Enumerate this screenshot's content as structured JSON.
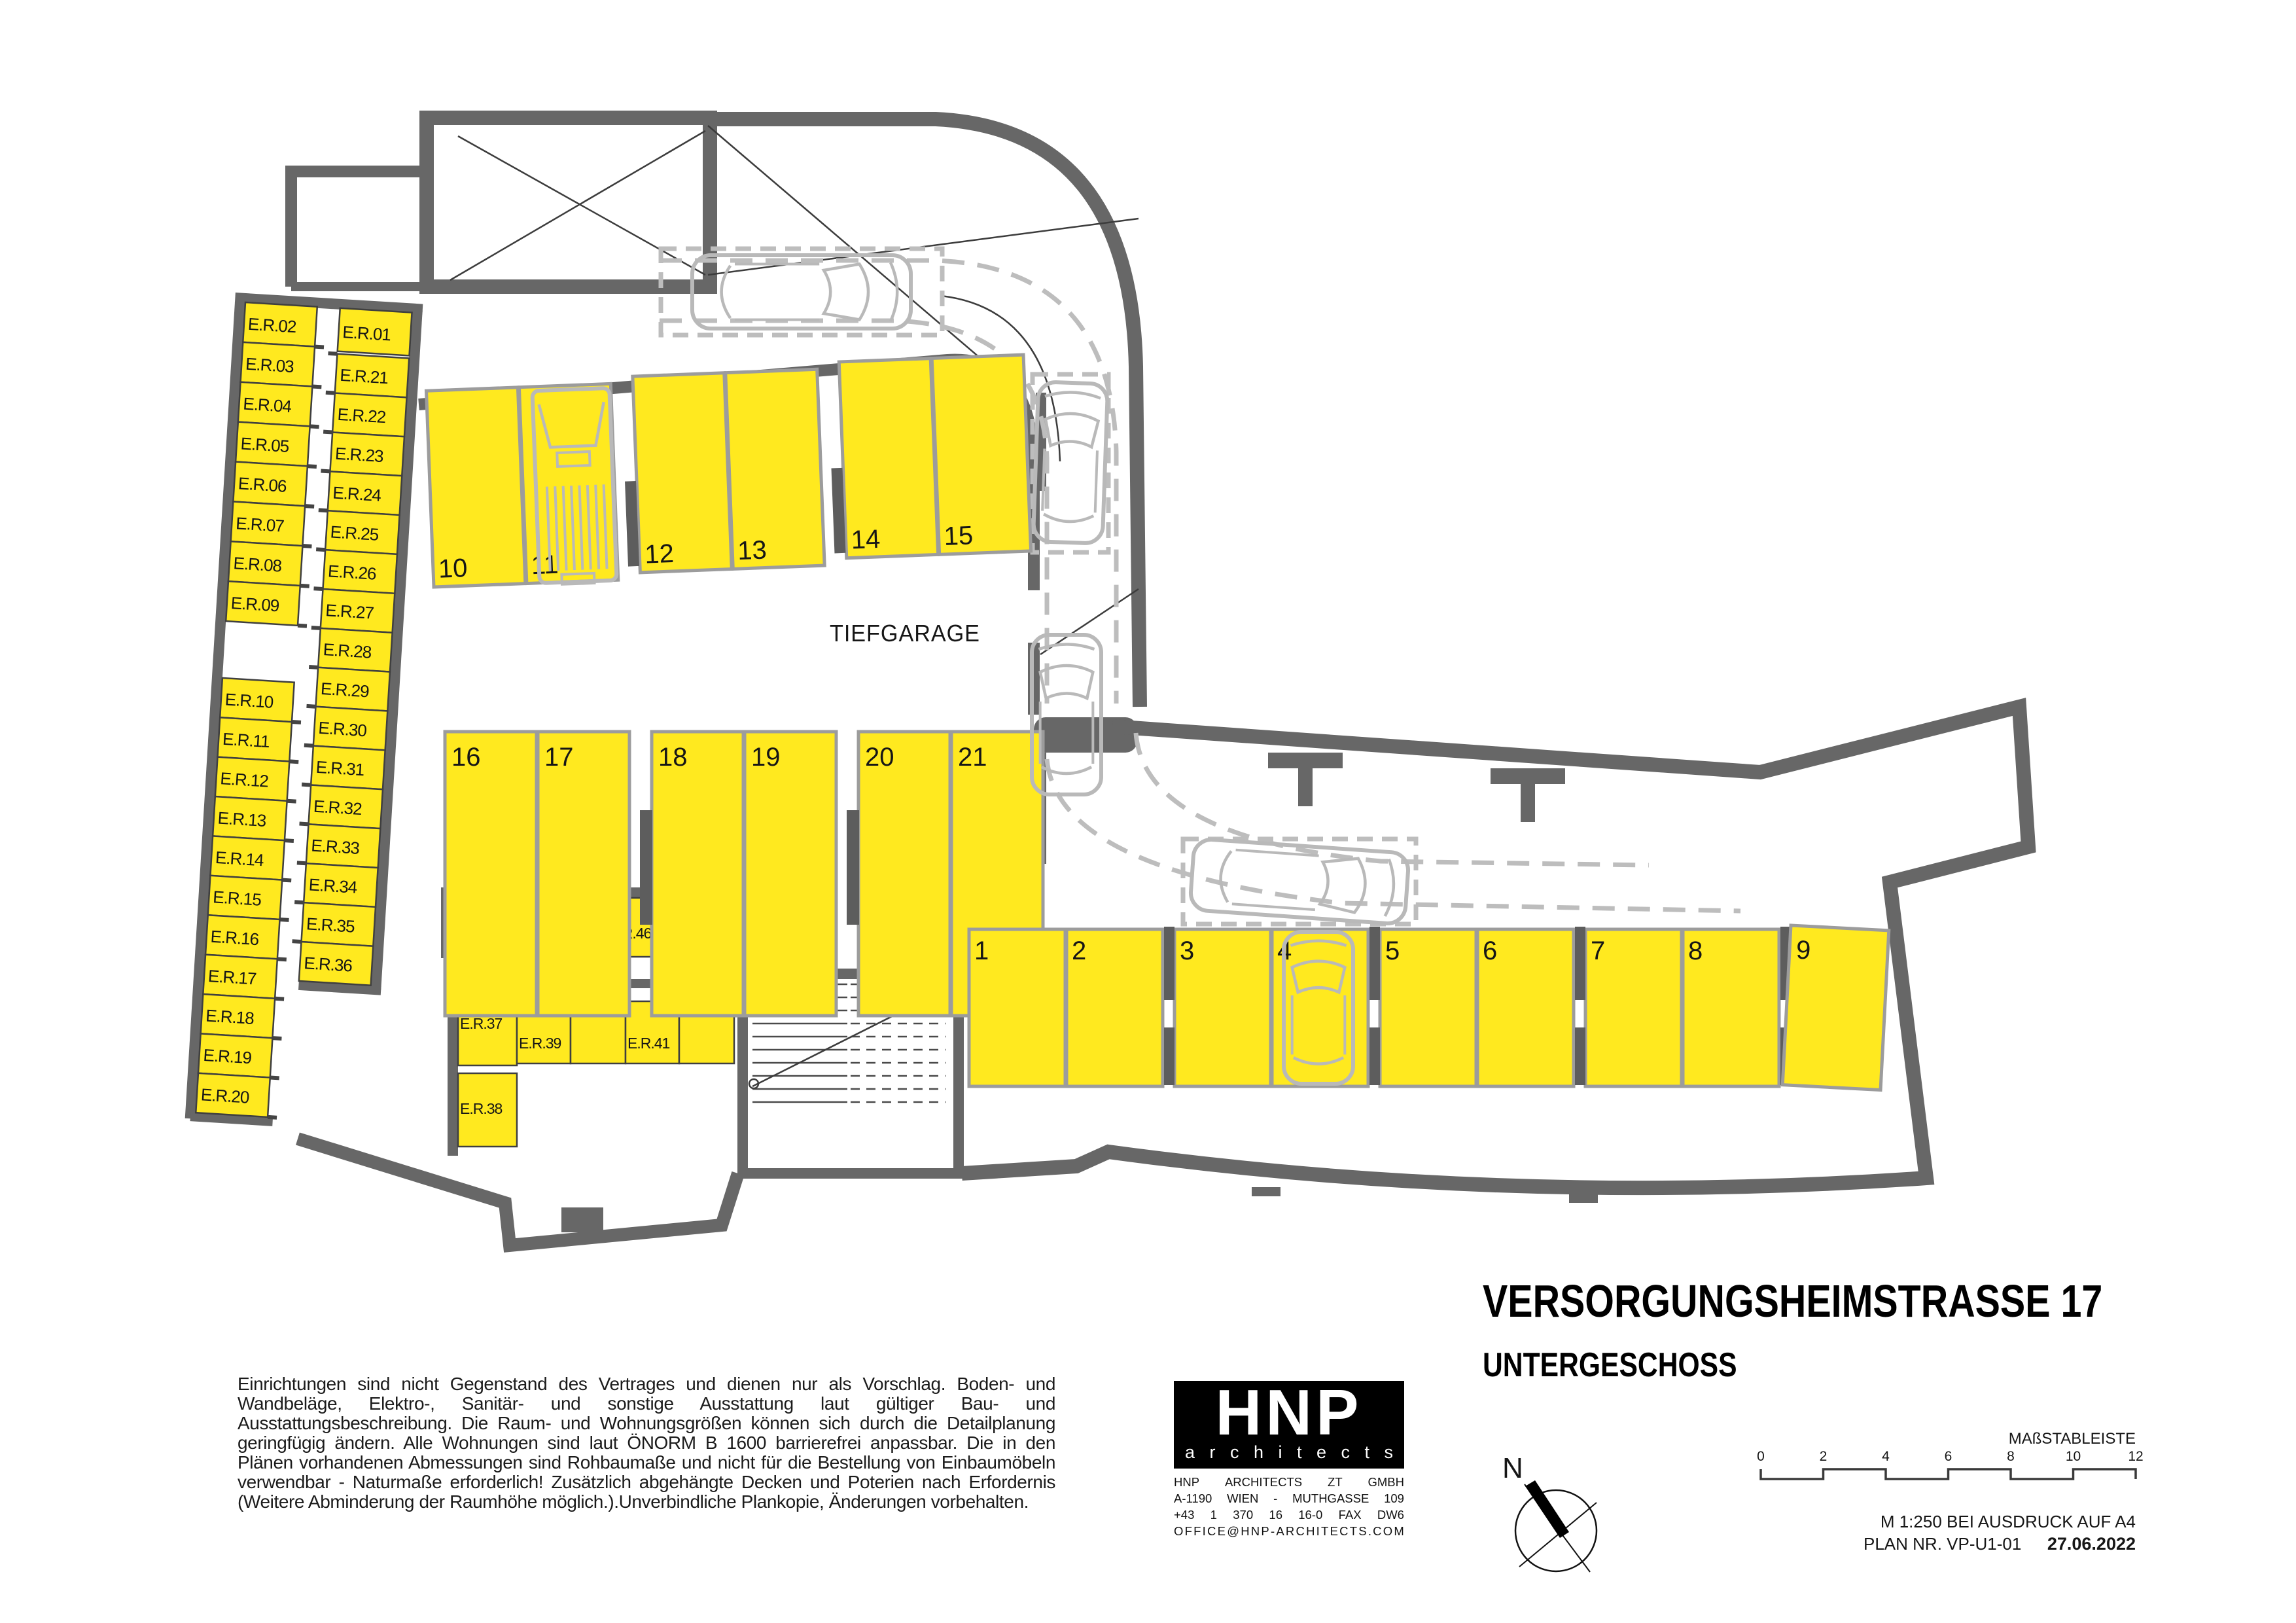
{
  "doc": {
    "title": "VERSORGUNGSHEIMSTRASSE 17",
    "subtitle": "UNTERGESCHOSS",
    "disclaimer": "Einrichtungen sind nicht Gegenstand des Vertrages und dienen nur als Vorschlag. Boden- und Wandbeläge, Elektro-, Sanitär- und sonstige Ausstattung laut gültiger Bau- und Ausstattungsbeschreibung. Die Raum- und Wohnungsgrößen können sich durch die Detailplanung geringfügig ändern. Alle Wohnungen sind laut ÖNORM B 1600 barrierefrei anpassbar. Die in den Plänen vorhandenen Abmessungen sind Rohbaumaße und nicht für die Bestellung von Einbaumöbeln verwendbar - Naturmaße erforderlich! Zusätzlich abgehängte Decken und Poterien nach Erfordernis (Weitere Abminderung der Raumhöhe möglich.).Unverbindliche Plankopie, Änderungen vorbehalten."
  },
  "logo": {
    "name": "HNP",
    "sub": "architects",
    "address_lines": [
      "HNP ARCHITECTS ZT GMBH",
      "A-1190 WIEN - MUTHGASSE 109",
      "+43 1 370 16 16-0 FAX DW6",
      "OFFICE@HNP-ARCHITECTS.COM"
    ]
  },
  "titleblock": {
    "scale_label": "MAßSTABLEISTE",
    "scale_ticks": [
      "0",
      "2",
      "4",
      "6",
      "8",
      "10",
      "12"
    ],
    "print_note": "M  1:250  BEI  AUSDRUCK  AUF  A4",
    "plan_nr": "PLAN NR. VP-U1-01",
    "date": "27.06.2022",
    "north": "N"
  },
  "plan": {
    "area_label": "TIEFGARAGE",
    "storage": {
      "col_a1": [
        "E.R.02",
        "E.R.03",
        "E.R.04",
        "E.R.05",
        "E.R.06",
        "E.R.07",
        "E.R.08",
        "E.R.09"
      ],
      "col_a2": [
        "E.R.10",
        "E.R.11",
        "E.R.12",
        "E.R.13",
        "E.R.14",
        "E.R.15",
        "E.R.16",
        "E.R.17",
        "E.R.18",
        "E.R.19",
        "E.R.20"
      ],
      "col_b_top": "E.R.01",
      "col_b": [
        "E.R.21",
        "E.R.22",
        "E.R.23",
        "E.R.24",
        "E.R.25",
        "E.R.26",
        "E.R.27",
        "E.R.28",
        "E.R.29",
        "E.R.30",
        "E.R.31",
        "E.R.32",
        "E.R.33",
        "E.R.34",
        "E.R.35",
        "E.R.36"
      ],
      "row_mid": [
        "E.R.43",
        "E.R.44",
        "E.R.45",
        "E.R.46",
        "E.R.RES."
      ],
      "cluster": [
        "E.R.37",
        "E.R.38",
        "E.R.39",
        "E.R.40",
        "E.R.41",
        "E.R.42"
      ]
    },
    "parking": {
      "top": [
        "10",
        "11",
        "12",
        "13",
        "14",
        "15"
      ],
      "middle": [
        "16",
        "17",
        "18",
        "19",
        "20",
        "21"
      ],
      "bottom": [
        "1",
        "2",
        "3",
        "4",
        "5",
        "6",
        "7",
        "8",
        "9"
      ]
    },
    "colors": {
      "room_fill": "#ffe91f",
      "wall": "#676767",
      "stall_border": "#9c9c9c",
      "ghost": "#b9b9b9",
      "ink": "#161616"
    }
  }
}
